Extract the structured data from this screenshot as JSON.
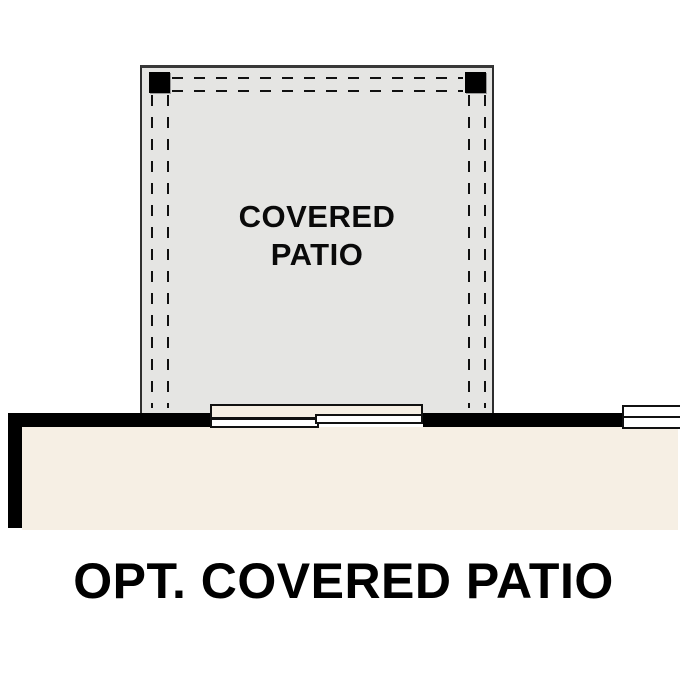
{
  "plan": {
    "patio_label": "COVERED PATIO",
    "caption": "OPT. COVERED PATIO"
  },
  "colors": {
    "patio_fill": "#e5e5e3",
    "interior_fill": "#f6efe4",
    "wall": "#000000",
    "line": "#111111",
    "text": "#000000"
  }
}
